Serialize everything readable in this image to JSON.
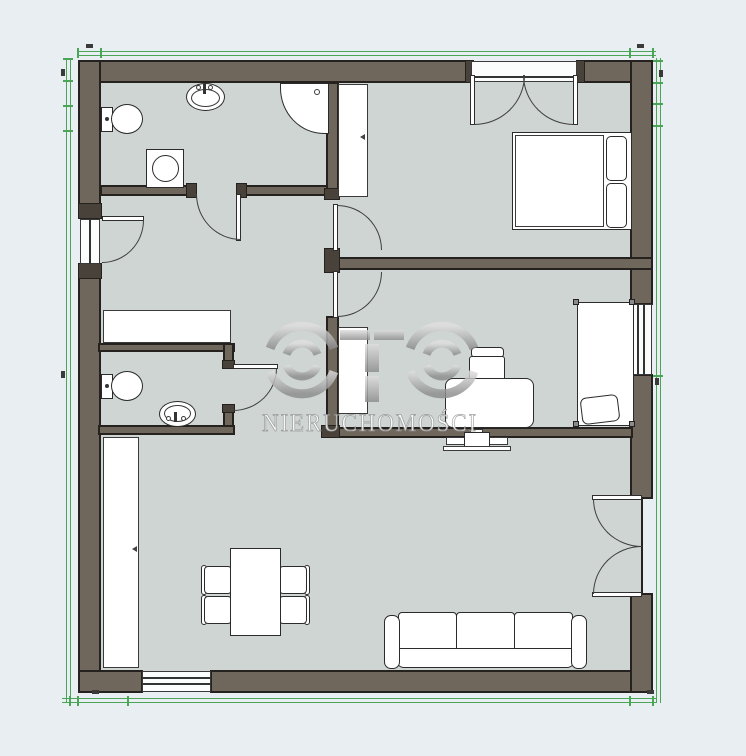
{
  "watermark": {
    "brand": "OTO",
    "subtitle": "NIERUCHOMOŚCI"
  },
  "palette": {
    "wall": "#6f665c",
    "wall_cap": "#49423a",
    "floor": "#ced5d2",
    "outline": "#24211e",
    "background": "#e9eef2",
    "boundary_green": "#4ba556",
    "watermark_silver": "#c6c6c6"
  },
  "plan": {
    "type": "apartment-floor-plan",
    "rooms": [
      "bathroom",
      "bedroom",
      "office-bedroom",
      "wc",
      "hall",
      "living-room"
    ],
    "fixtures": [
      "toilet",
      "washbasin",
      "corner-shower",
      "washing-machine",
      "wardrobe",
      "double-bed",
      "pillows",
      "balcony-french-door",
      "desk",
      "office-chair",
      "single-bed",
      "window",
      "toilet",
      "washbasin",
      "hall-closet",
      "tall-wardrobe",
      "dining-table",
      "four-chairs",
      "ceiling-fan",
      "three-seat-sofa",
      "french-door",
      "entrance-door",
      "window"
    ]
  }
}
